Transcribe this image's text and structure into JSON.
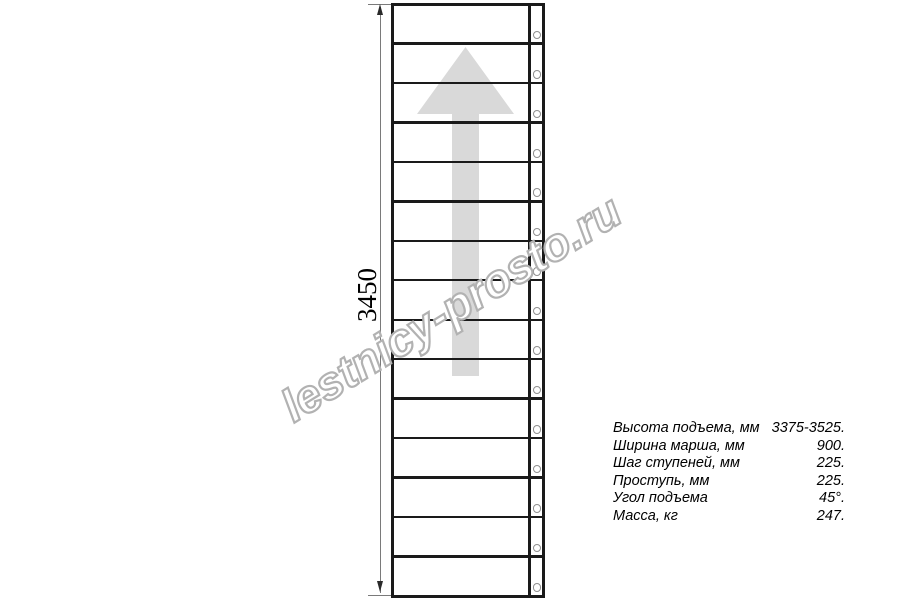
{
  "colors": {
    "background": "#ffffff",
    "line": "#1a1a1a",
    "dimension_line": "#7a7a7a",
    "dimension_arrowhead": "#2a2a2a",
    "bolt_outline": "#8f8f8f",
    "direction_arrow_fill": "#d9d9d9",
    "watermark_outline": "#b2b2b2",
    "watermark_fill": "#ffffff",
    "text": "#000000"
  },
  "drawing": {
    "dimension_label": "3450",
    "tread_count": 15,
    "bolt_count": 15,
    "direction_arrow": "up"
  },
  "watermark": {
    "text": "lestnicy-prosto.ru"
  },
  "specs": {
    "rows": [
      {
        "label": "Высота подъема, мм",
        "value": "3375-3525."
      },
      {
        "label": "Ширина марша, мм",
        "value": "900."
      },
      {
        "label": "Шаг ступеней, мм",
        "value": "225."
      },
      {
        "label": "Проступь, мм",
        "value": "225."
      },
      {
        "label": "Угол подъема",
        "value": "45°."
      },
      {
        "label": "Масса, кг",
        "value": "247."
      }
    ]
  }
}
